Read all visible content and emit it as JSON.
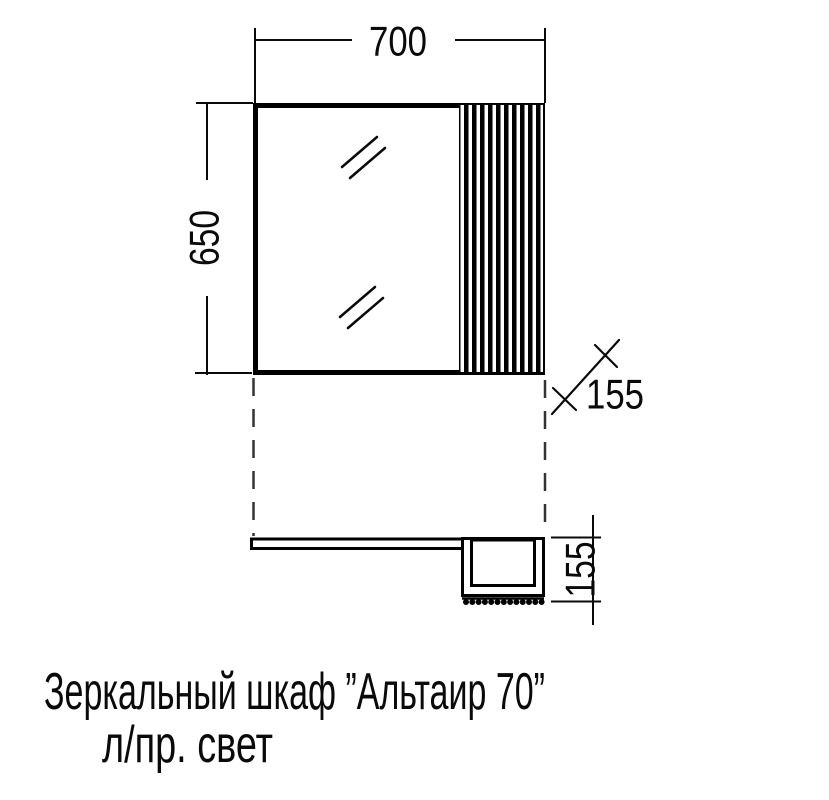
{
  "colors": {
    "background": "#ffffff",
    "line": "#000000"
  },
  "dimensions": {
    "width": "700",
    "height": "650",
    "depth_diagonal": "155",
    "depth_plan": "155"
  },
  "caption": {
    "line1": "Зеркальный шкаф ”Альтаир 70”",
    "line2": "л/пр. свет"
  }
}
